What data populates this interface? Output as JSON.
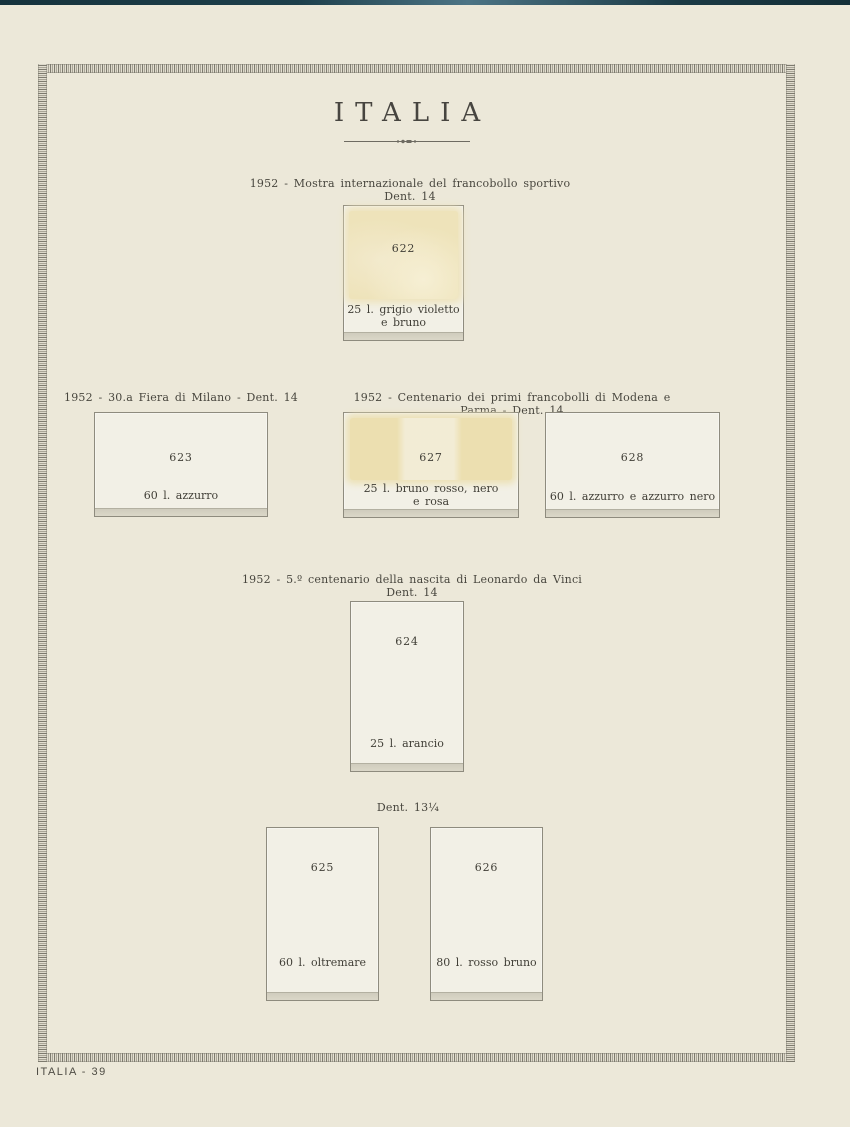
{
  "page": {
    "title": "ITALIA",
    "footer": "ITALIA - 39"
  },
  "sections": {
    "sportivo": {
      "line1": "1952 - Mostra internazionale del francobollo sportivo",
      "line2": "Dent. 14"
    },
    "fiera_milano": {
      "line1": "1952 - 30.a Fiera di Milano - Dent. 14"
    },
    "modena_parma": {
      "line1": "1952 - Centenario dei primi francobolli di Modena e Parma - Dent. 14"
    },
    "leonardo": {
      "line1": "1952 - 5.º centenario della nascita di Leonardo da Vinci",
      "line2": "Dent. 14"
    },
    "dent1314": {
      "line1": "Dent. 13¼"
    }
  },
  "stamps": {
    "s622": {
      "number": "622",
      "caption1": "25 l. grigio violetto",
      "caption2": "e bruno"
    },
    "s623": {
      "number": "623",
      "caption1": "60 l. azzurro"
    },
    "s627": {
      "number": "627",
      "caption1": "25 l. bruno rosso, nero",
      "caption2": "e rosa"
    },
    "s628": {
      "number": "628",
      "caption1": "60 l. azzurro e azzurro nero"
    },
    "s624": {
      "number": "624",
      "caption1": "25 l. arancio"
    },
    "s625": {
      "number": "625",
      "caption1": "60 l. oltremare"
    },
    "s626": {
      "number": "626",
      "caption1": "80 l. rosso bruno"
    }
  },
  "colors": {
    "paper": "#ece8d9",
    "stamp_slot_bg": "#f2f0e6",
    "slot_border": "#8e8b7e",
    "ghost_stamp_yellow": "#eee3ba",
    "ink": "#403e36",
    "border_tick": "#7d7a6e",
    "scanner_edge": "#16333d"
  }
}
